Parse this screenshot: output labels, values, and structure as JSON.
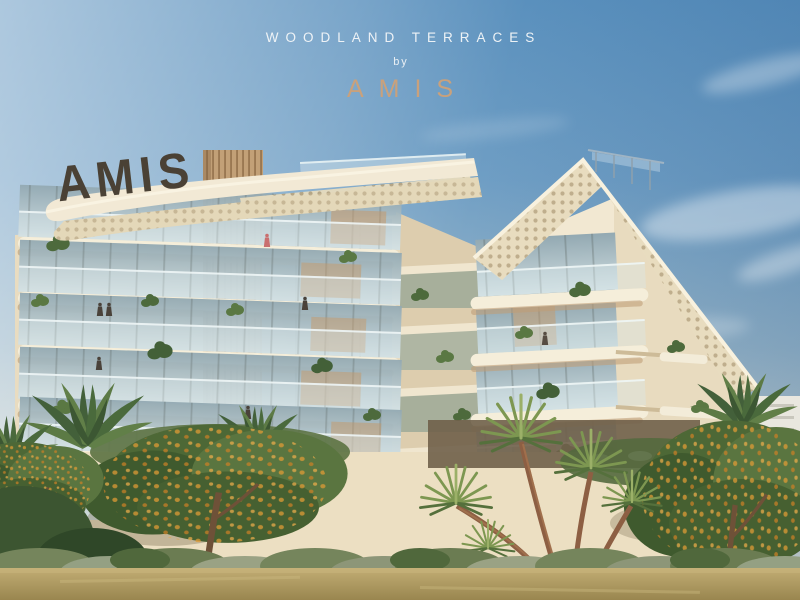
{
  "header": {
    "project_title": "WOODLAND TERRACES",
    "byline": "by",
    "brand": "AMIS"
  },
  "building": {
    "sign": "AMIS"
  },
  "palette": {
    "sky_top": "#4a86b8",
    "sky_light": "#aabfcd",
    "horizon_haze": "#e9e6db",
    "canopy_cream": "#f2e9d5",
    "facade_cream": "#f1e7d1",
    "slab_shadow": "#bf9f78",
    "louver_wood": "#c2a077",
    "glass_blue": "#9eb4bd",
    "brand_gold": "#c9a17c",
    "sign_bronze": "#4a4135",
    "foliage_green": "#4e6a3e",
    "blossom_orange": "#dd9734",
    "dry_grass": "#b3a06a"
  }
}
